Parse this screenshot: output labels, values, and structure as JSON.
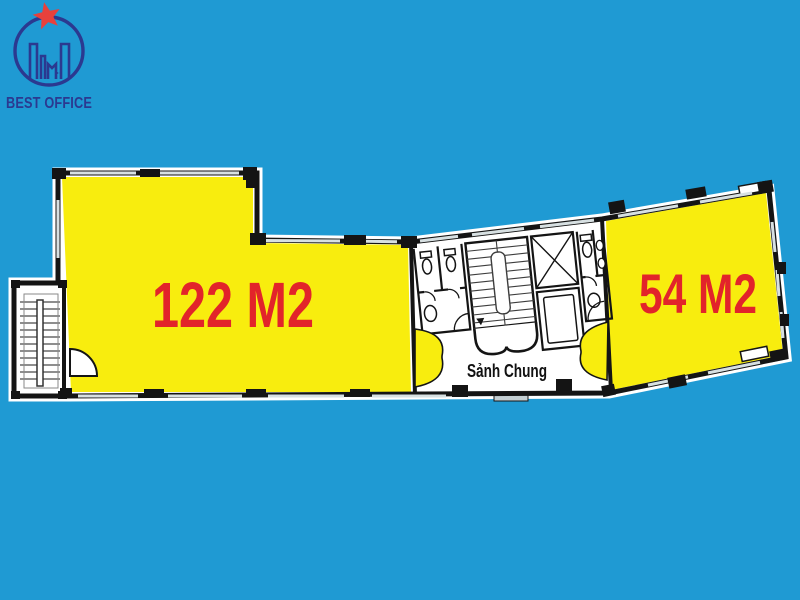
{
  "canvas": {
    "width": 800,
    "height": 600,
    "background_color": "#1f9ad3"
  },
  "logo": {
    "brand": "BEST OFFICE",
    "brand_color": "#2b3990",
    "star_color": "#e8413c"
  },
  "floorplan": {
    "wall_color": "#141414",
    "floor_color": "#ffffff",
    "unit_fill_color": "#f8ed0e",
    "unit_label_color": "#e2242a",
    "units": [
      {
        "id": "unit-122",
        "label": "122 M2"
      },
      {
        "id": "unit-54",
        "label": "54 M2"
      }
    ],
    "lobby": {
      "label": "Sảnh Chung",
      "label_color": "#111111"
    },
    "features": [
      "side-stairwell",
      "wc-left",
      "main-staircase",
      "elevator-shaft",
      "elevator",
      "wc-right",
      "common-lobby",
      "entrance-threshold",
      "double-door-left",
      "double-door-right",
      "window",
      "column"
    ]
  }
}
